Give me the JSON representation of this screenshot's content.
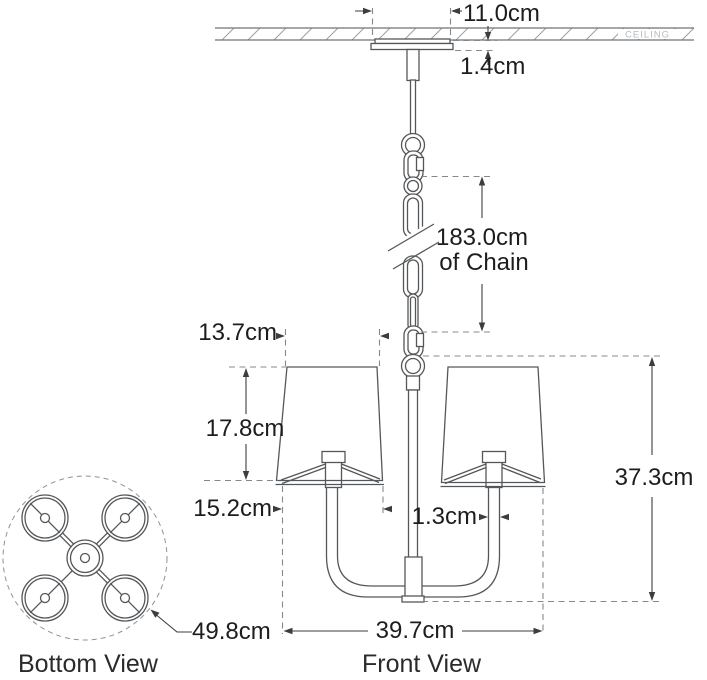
{
  "diagram": {
    "ceiling_label": "CEILING",
    "view_labels": {
      "bottom": "Bottom View",
      "front": "Front View"
    },
    "dimensions": {
      "canopy_width": "11.0cm",
      "canopy_height": "1.4cm",
      "chain_length": "183.0cm",
      "chain_length_suffix": "of Chain",
      "shade_top_width": "13.7cm",
      "shade_height": "17.8cm",
      "shade_bottom_width": "15.2cm",
      "arm_diameter": "1.3cm",
      "fixture_height": "37.3cm",
      "fixture_width": "39.7cm",
      "overall_diameter": "49.8cm"
    },
    "colors": {
      "background": "#ffffff",
      "geometry_line": "#54575a",
      "dimension_line": "#3b3d3f",
      "dashed_line": "#84888c",
      "hatch_line": "#9aa0a5",
      "text": "#1d1d1d",
      "ceiling_text": "#b6babd"
    }
  }
}
